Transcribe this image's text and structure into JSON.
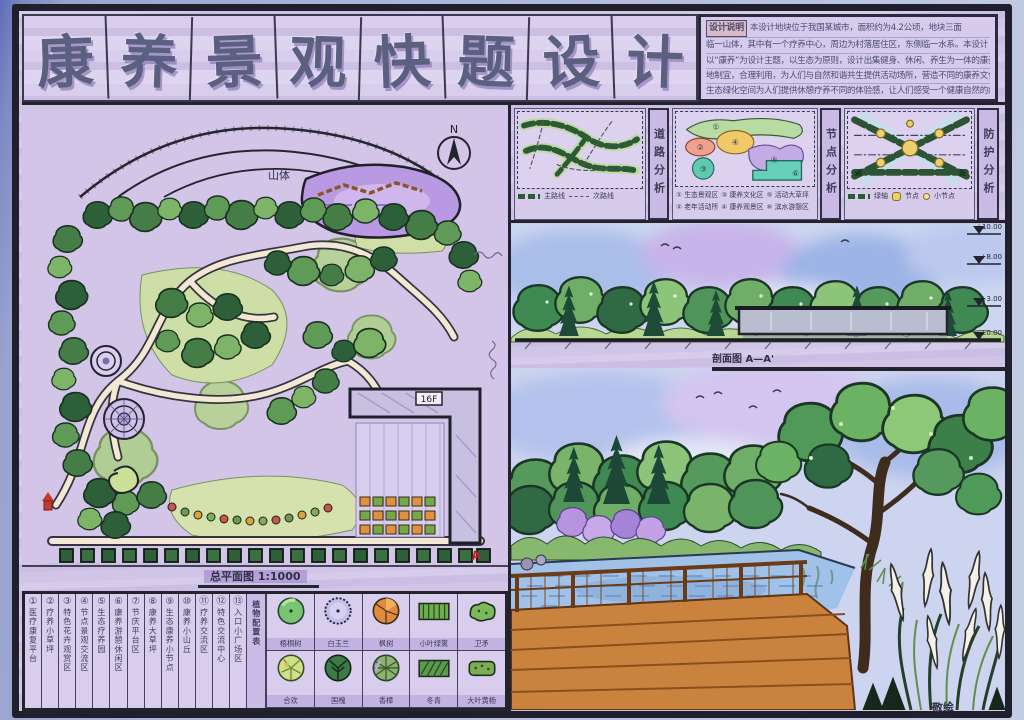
{
  "title": {
    "chars": [
      "康",
      "养",
      "景",
      "观",
      "快",
      "题",
      "设",
      "计"
    ]
  },
  "design_notes": {
    "heading": "设计说明",
    "colon": "：",
    "lines": [
      "本设计地块位于我国某城市，面积约为4.2公顷，地块三面",
      "临一山体，其中有一个疗养中心，周边为村落居住区，东侧临一水系。本设计",
      "以“康养”为设计主题，以生态为原则，设计出集健身、休闲、养生为一体的康养场所，因",
      "地制宜，合理利用，为人们与自然和谐共生提供活动场所，营造不同的康养文化，",
      "生态绿化空间为人们提供休憩疗养不同的体验感，让人们感受一个健康自然的疗养环境。"
    ]
  },
  "analysis": {
    "road": {
      "label": "道路分析",
      "primary": "主路线",
      "secondary": "次路线"
    },
    "node": {
      "label": "节点分析",
      "badges": [
        "①",
        "②",
        "③",
        "④",
        "⑤",
        "⑥"
      ],
      "items": [
        "① 生态景观区",
        "③ 康养文化区",
        "⑤ 活动大草坪",
        "② 老年活动所",
        "④ 康养观景区",
        "⑥ 滨水游憩区"
      ]
    },
    "protection": {
      "label": "防护分析",
      "items": [
        "绿轴",
        "节点",
        "小节点"
      ]
    }
  },
  "plan": {
    "north_label": "N",
    "mountain_label": "山体",
    "building_label": "16F",
    "section_marker": "A",
    "caption": "总平面图 1:1000"
  },
  "legend": {
    "items": [
      {
        "num": "①",
        "name": "医疗康复平台"
      },
      {
        "num": "②",
        "name": "疗养小草坪"
      },
      {
        "num": "③",
        "name": "特色花卉观赏区"
      },
      {
        "num": "④",
        "name": "节点景观交流区"
      },
      {
        "num": "⑤",
        "name": "生态疗养园"
      },
      {
        "num": "⑥",
        "name": "康养游憩休闲区"
      },
      {
        "num": "⑦",
        "name": "节庆平台区"
      },
      {
        "num": "⑧",
        "name": "康养大草坪"
      },
      {
        "num": "⑨",
        "name": "生态康养小节点"
      },
      {
        "num": "⑩",
        "name": "康养小山丘"
      },
      {
        "num": "⑪",
        "name": "疗养交流区"
      },
      {
        "num": "⑫",
        "name": "特色交流中心"
      },
      {
        "num": "⑬",
        "name": "入口小广场区"
      }
    ],
    "plants_header": "植物配置表",
    "plants": [
      "梧桐树",
      "白玉兰",
      "枫树",
      "小叶绿篱",
      "卫矛",
      "合欢",
      "国槐",
      "香樟",
      "冬青",
      "大叶黄杨"
    ]
  },
  "section": {
    "caption": "剖面图 A—A'",
    "elevations": [
      "+10.00",
      "+8.00",
      "+3.00",
      "±0.00"
    ]
  },
  "signature": "敬绘"
}
